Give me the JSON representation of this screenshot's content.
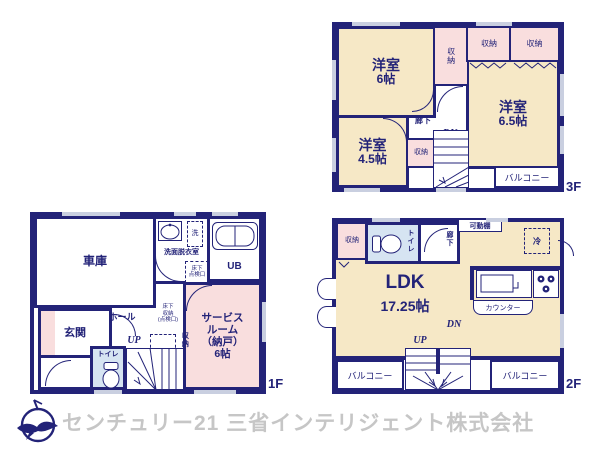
{
  "colors": {
    "wall_navy": "#232378",
    "room_cream": "#f6e8c6",
    "room_pink": "#f9dede",
    "room_blue": "#d6e4f2",
    "window_gray": "#c9cfe0",
    "footer_gray": "#c6c6c6"
  },
  "f3": {
    "floor_label": "3F",
    "room6": {
      "name": "洋室",
      "size": "6帖"
    },
    "room65": {
      "name": "洋室",
      "size": "6.5帖"
    },
    "room45": {
      "name": "洋室",
      "size": "4.5帖"
    },
    "closet_v": "収納",
    "closet_a": "収納",
    "closet_b": "収納",
    "closet_st": "収納",
    "hall": "廊下",
    "dn": "DN",
    "balcony": "バルコニー"
  },
  "f1": {
    "floor_label": "1F",
    "garage": "車庫",
    "washroom": "洗面脱衣室",
    "laundry": "洗",
    "inspection": "床下\n点検口",
    "ub": "UB",
    "entrance": "玄関",
    "hall": "ホール",
    "up": "UP",
    "underfloor": "床下\n収納\n(点検口)",
    "closet": "収納",
    "toilet": "トイレ",
    "service": "サービス\nルーム\n（納戸）\n6帖"
  },
  "f2": {
    "floor_label": "2F",
    "closet": "収納",
    "toilet": "トイレ",
    "hall": "廊下",
    "shelf": "可動棚",
    "fridge": "冷",
    "ldk": {
      "name": "LDK",
      "size": "17.25帖"
    },
    "counter": "カウンター",
    "up": "UP",
    "dn": "DN",
    "balcony_l": "バルコニー",
    "balcony_r": "バルコニー"
  },
  "footer": {
    "company": "センチュリー21 三省インテリジェント株式会社"
  }
}
